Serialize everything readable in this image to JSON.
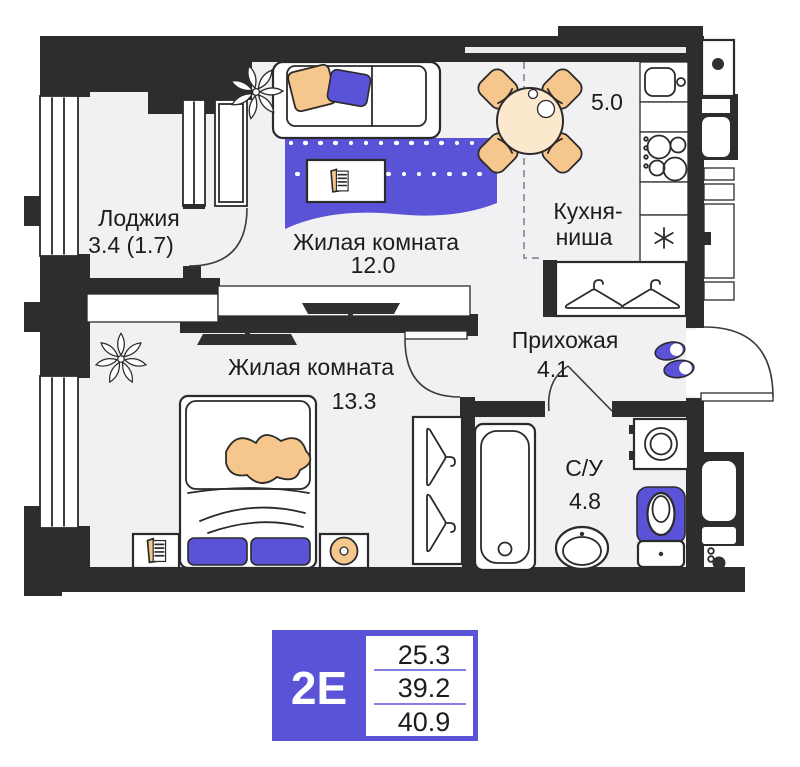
{
  "rooms": {
    "loggia": {
      "name": "Лоджия",
      "area": "3.4 (1.7)"
    },
    "living_room": {
      "name": "Жилая комната",
      "area": "12.0"
    },
    "kitchen_niche": {
      "name_line1": "Кухня-",
      "name_line2": "ниша",
      "area": "5.0"
    },
    "hallway": {
      "name": "Прихожая",
      "area": "4.1"
    },
    "bedroom": {
      "name": "Жилая комната",
      "area": "13.3"
    },
    "bathroom": {
      "name": "С/У",
      "area": "4.8"
    }
  },
  "legend": {
    "plan_type": "2Е",
    "area_values": [
      "25.3",
      "39.2",
      "40.9"
    ]
  },
  "colors": {
    "wall": "#2e2d2e",
    "floor": "#f1f0f2",
    "accent_blue": "#5a53d7",
    "furniture_orange": "#f6c78d",
    "table_cream": "#fbe8cd",
    "outline": "#2b2b2b"
  },
  "icons": {
    "fridge": "snowflake-asterisk-icon",
    "hallway": "slippers-icon",
    "wardrobes": "hanger-icon",
    "plants": "flower-icon",
    "tv": "tv-icon"
  }
}
